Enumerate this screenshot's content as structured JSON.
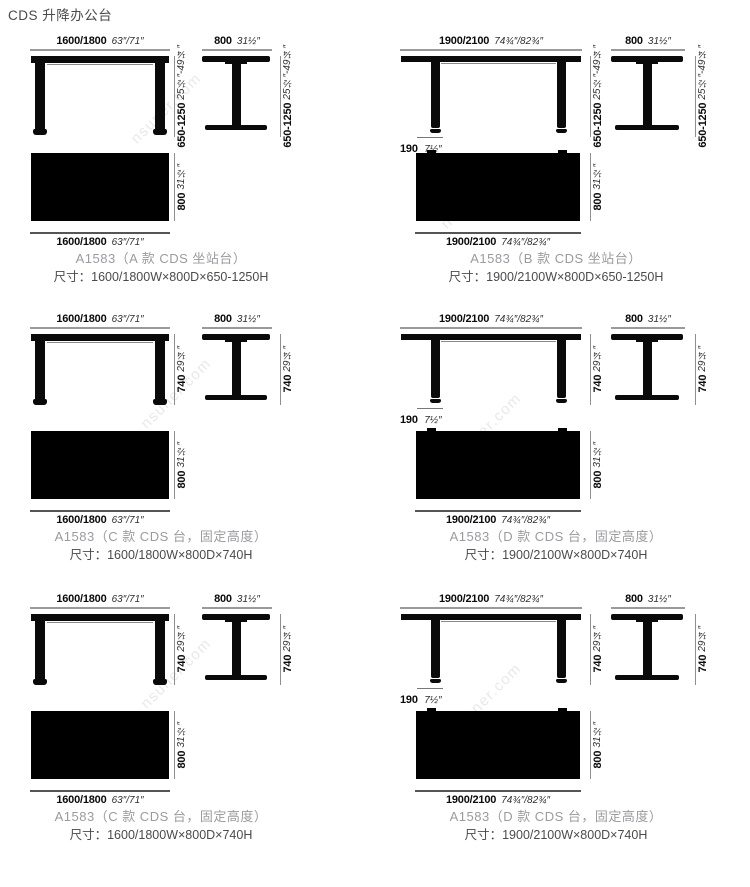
{
  "page": {
    "title": "CDS 升降办公台",
    "watermark": "nsuner.com"
  },
  "colors": {
    "drawing": "#0a0a0a",
    "dimension_line": "#9a9a9a",
    "caption_gray": "#9a9ba0",
    "size_text": "#4b4b4b"
  },
  "panels": [
    {
      "front": {
        "mm": "1600/1800",
        "inch": "63″/71″"
      },
      "height": {
        "mm": "650-1250",
        "inch": "25½″-49¼″"
      },
      "side": {
        "mm": "800",
        "inch": "31½″"
      },
      "depth": {
        "mm": "800",
        "inch": "31½″"
      },
      "top": {
        "mm": "1600/1800",
        "inch": "63″/71″"
      },
      "caption": "A1583（A 款 CDS 坐站台）",
      "size": "尺寸：1600/1800W×800D×650-1250H"
    },
    {
      "front": {
        "mm": "1900/2100",
        "inch": "74¾″/82¾″"
      },
      "height": {
        "mm": "650-1250",
        "inch": "25½″-49¼″"
      },
      "side": {
        "mm": "800",
        "inch": "31½″"
      },
      "depth": {
        "mm": "800",
        "inch": "31½″"
      },
      "top": {
        "mm": "1900/2100",
        "inch": "74¾″/82¾″"
      },
      "overhang": {
        "mm": "190",
        "inch": "7½″"
      },
      "caption": "A1583（B 款 CDS 坐站台）",
      "size": "尺寸：1900/2100W×800D×650-1250H"
    },
    {
      "front": {
        "mm": "1600/1800",
        "inch": "63″/71″"
      },
      "height": {
        "mm": "740",
        "inch": "29¼″"
      },
      "side": {
        "mm": "800",
        "inch": "31½″"
      },
      "depth": {
        "mm": "800",
        "inch": "31½″"
      },
      "top": {
        "mm": "1600/1800",
        "inch": "63″/71″"
      },
      "caption": "A1583（C 款 CDS 台，固定高度）",
      "size": "尺寸：1600/1800W×800D×740H"
    },
    {
      "front": {
        "mm": "1900/2100",
        "inch": "74¾″/82¾″"
      },
      "height": {
        "mm": "740",
        "inch": "29¼″"
      },
      "side": {
        "mm": "800",
        "inch": "31½″"
      },
      "depth": {
        "mm": "800",
        "inch": "31½″"
      },
      "top": {
        "mm": "1900/2100",
        "inch": "74¾″/82¾″"
      },
      "overhang": {
        "mm": "190",
        "inch": "7½″"
      },
      "caption": "A1583（D 款 CDS 台，固定高度）",
      "size": "尺寸：1900/2100W×800D×740H"
    },
    {
      "front": {
        "mm": "1600/1800",
        "inch": "63″/71″"
      },
      "height": {
        "mm": "740",
        "inch": "29¼″"
      },
      "side": {
        "mm": "800",
        "inch": "31½″"
      },
      "depth": {
        "mm": "800",
        "inch": "31½″"
      },
      "top": {
        "mm": "1600/1800",
        "inch": "63″/71″"
      },
      "caption": "A1583（C 款 CDS 台，固定高度）",
      "size": "尺寸：1600/1800W×800D×740H"
    },
    {
      "front": {
        "mm": "1900/2100",
        "inch": "74¾″/82¾″"
      },
      "height": {
        "mm": "740",
        "inch": "29¼″"
      },
      "side": {
        "mm": "800",
        "inch": "31½″"
      },
      "depth": {
        "mm": "800",
        "inch": "31½″"
      },
      "top": {
        "mm": "1900/2100",
        "inch": "74¾″/82¾″"
      },
      "overhang": {
        "mm": "190",
        "inch": "7½″"
      },
      "caption": "A1583（D 款 CDS 台，固定高度）",
      "size": "尺寸：1900/2100W×800D×740H"
    }
  ]
}
